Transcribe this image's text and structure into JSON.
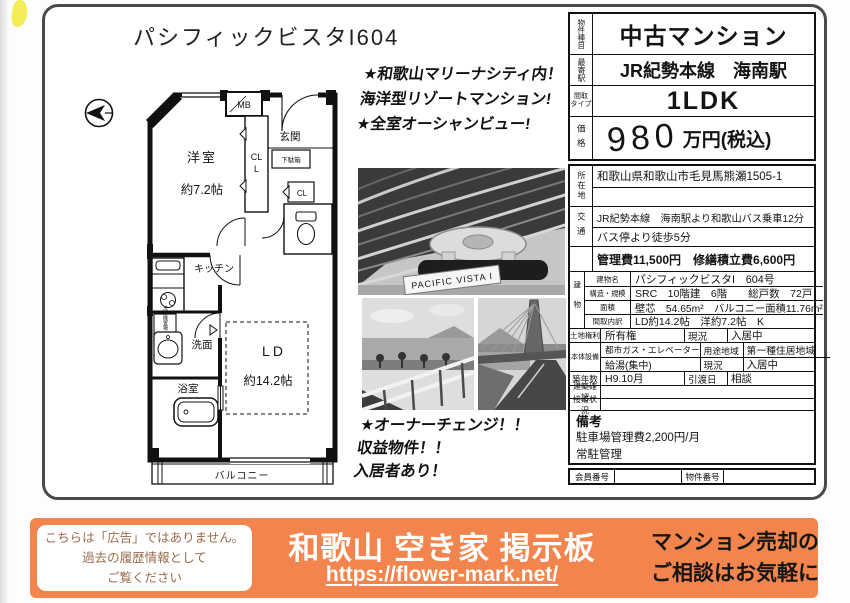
{
  "title": "パシフィックビスタI604",
  "colors": {
    "accent_orange": "#F2854E",
    "highlight_yellow": "#F3EE57"
  },
  "floorplan": {
    "western_room": "洋室",
    "western_room_size": "約7.2帖",
    "mb": "MB",
    "entrance": "玄関",
    "closet1": "CL",
    "shoe_box": "下駄箱",
    "closet2": "CL",
    "kitchen": "キッチン",
    "laundry": "洗濯機置場",
    "washroom": "洗面",
    "bathroom": "浴室",
    "ld": "LD",
    "ld_size": "約14.2帖",
    "balcony": "バルコニー"
  },
  "photos": {
    "building_sign": "PACIFIC VISTA I"
  },
  "callouts": {
    "top1": "★和歌山マリーナシティ内！",
    "top2": "海洋型リゾートマンション!",
    "top3": "★全室オーシャンビュー!",
    "bottom1": "★オーナーチェンジ！！",
    "bottom2": "収益物件！！",
    "bottom3": "入居者あり！"
  },
  "spec": {
    "type_label": "物件種目",
    "type_value": "中古マンション",
    "station_label": "最寄駅",
    "station_value": "JR紀勢本線　海南駅",
    "layout_label_1": "間取",
    "layout_label_2": "タイプ",
    "layout_value": "1LDK",
    "price_label": "価格",
    "price_number": "980",
    "price_unit": "万円(税込)",
    "address_label": "所在地",
    "address_value": "和歌山県和歌山市毛見馬熊瀬1505-1",
    "access_label": "交通",
    "access_line1": "JR紀勢本線　海南駅より和歌山バス乗車12分",
    "access_line2": "バス停より徒歩5分",
    "fees": "管理費11,500円　修繕積立費6,600円",
    "building_label": "建物",
    "building_name_label": "建物名",
    "building_name": "パシフィックビスタI　604号",
    "structure_label": "構造・規模",
    "structure_value": "SRC　10階建　6階　　総戸数　72戸",
    "area_label": "面積",
    "area_value": "壁芯　54.65m²　バルコニー面積11.76m²",
    "layout_detail_label": "間取内訳",
    "layout_detail_value": "LD約14.2帖　洋約7.2帖　K",
    "land_rights_label": "土地権利",
    "land_rights_value": "所有権",
    "status_label1": "現況",
    "status_value1": "入居中",
    "equipment_label": "本体設備",
    "equipment_value1": "都市ガス・エレベーター",
    "zoning_label": "用途地域",
    "zoning_value": "第一種住居地域",
    "equipment_value2": "給湯(集中)",
    "status_label2": "現況",
    "status_value2": "入居中",
    "age_label": "築年数",
    "age_value": "H9.10月",
    "handover_label": "引渡日",
    "handover_value": "相談",
    "building_confirm_label": "建築確認",
    "road_label": "接道状況",
    "remarks_label": "備考",
    "remarks_line1": "駐車場管理費2,200円/月",
    "remarks_line2": "常駐管理",
    "member_no_label": "会員番号",
    "property_no_label": "物件番号"
  },
  "banner": {
    "notice_line1": "こちらは「広告」ではありません。",
    "notice_line2": "過去の履歴情報として",
    "notice_line3": "ご覧ください",
    "site_title": "和歌山 空き家 掲示板",
    "site_url": "https://flower-mark.net/",
    "cta_line1": "マンション売却の",
    "cta_line2": "ご相談はお気軽に"
  }
}
